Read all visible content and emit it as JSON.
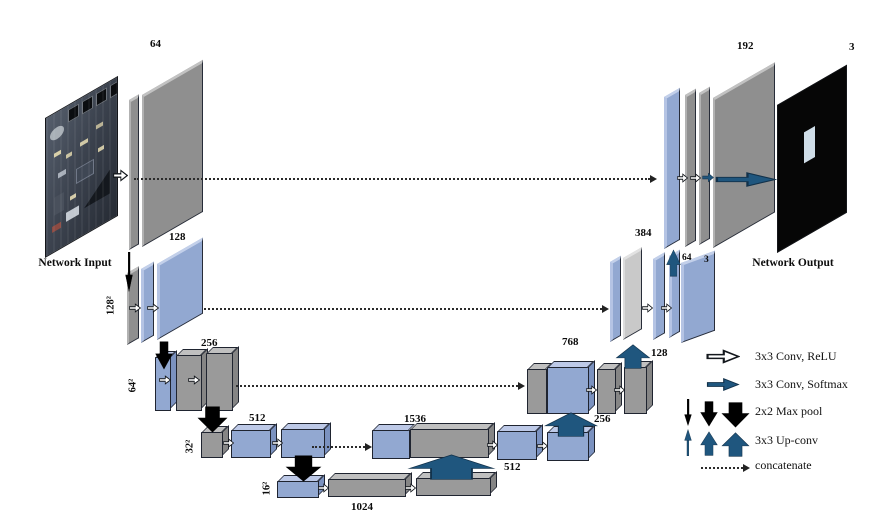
{
  "network": {
    "input_label": "Network Input",
    "output_label": "Network Output",
    "channel_labels": {
      "c64": "64",
      "c128": "128",
      "c256": "256",
      "c512": "512",
      "c1024": "1024",
      "c1536": "1536",
      "c512d": "512",
      "c256u": "256",
      "c768": "768",
      "c128u": "128",
      "c384": "384",
      "c64d": "64",
      "c3d": "3",
      "c192": "192",
      "c3out": "3"
    },
    "resolution_labels": {
      "r128": "128²",
      "r64": "64²",
      "r32": "32²",
      "r16": "16²"
    }
  },
  "legend": {
    "items": [
      {
        "name": "conv-relu",
        "label": "3x3 Conv, ReLU"
      },
      {
        "name": "conv-softmax",
        "label": "3x3 Conv, Softmax"
      },
      {
        "name": "max-pool",
        "label": "2x2 Max pool"
      },
      {
        "name": "up-conv",
        "label": "3x3 Up-conv"
      },
      {
        "name": "concatenate",
        "label": "concatenate"
      }
    ]
  },
  "colors": {
    "feature_blue": "#92a8d1",
    "feature_gray": "#979797",
    "feature_lightgray": "#c9c9c9",
    "arrow_navy": "#1f567e",
    "arrow_black": "#000000",
    "arrow_white": "#ffffff",
    "background": "#ffffff"
  }
}
